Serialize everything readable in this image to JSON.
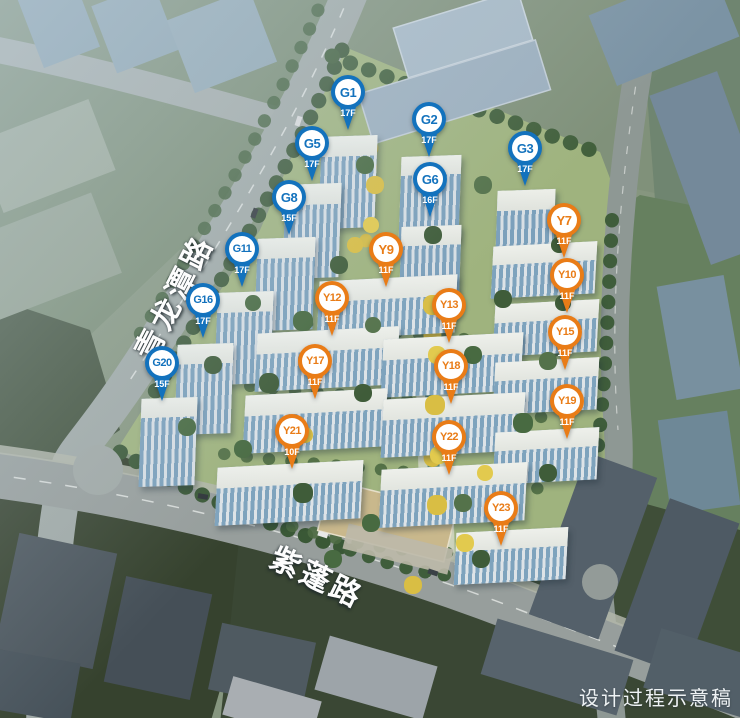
{
  "scene": {
    "watermark": "设计过程示意稿",
    "roads": [
      {
        "name": "青龙潭路"
      },
      {
        "name": "紫蓬路"
      }
    ]
  },
  "colors": {
    "pin_blue": "#1372bd",
    "pin_orange": "#e97c17"
  },
  "pins": [
    {
      "id": "G1",
      "floor": "17F",
      "type": "blue",
      "x": 348,
      "y": 92
    },
    {
      "id": "G2",
      "floor": "17F",
      "type": "blue",
      "x": 429,
      "y": 119
    },
    {
      "id": "G3",
      "floor": "17F",
      "type": "blue",
      "x": 525,
      "y": 148
    },
    {
      "id": "G5",
      "floor": "17F",
      "type": "blue",
      "x": 312,
      "y": 143
    },
    {
      "id": "G6",
      "floor": "16F",
      "type": "blue",
      "x": 430,
      "y": 179
    },
    {
      "id": "G8",
      "floor": "15F",
      "type": "blue",
      "x": 289,
      "y": 197
    },
    {
      "id": "G11",
      "floor": "17F",
      "type": "blue",
      "x": 242,
      "y": 249
    },
    {
      "id": "G16",
      "floor": "17F",
      "type": "blue",
      "x": 203,
      "y": 300
    },
    {
      "id": "G20",
      "floor": "15F",
      "type": "blue",
      "x": 162,
      "y": 363
    },
    {
      "id": "Y7",
      "floor": "11F",
      "type": "orange",
      "x": 564,
      "y": 220
    },
    {
      "id": "Y9",
      "floor": "11F",
      "type": "orange",
      "x": 386,
      "y": 249
    },
    {
      "id": "Y10",
      "floor": "11F",
      "type": "orange",
      "x": 567,
      "y": 275
    },
    {
      "id": "Y12",
      "floor": "11F",
      "type": "orange",
      "x": 332,
      "y": 298
    },
    {
      "id": "Y13",
      "floor": "11F",
      "type": "orange",
      "x": 449,
      "y": 305
    },
    {
      "id": "Y15",
      "floor": "11F",
      "type": "orange",
      "x": 565,
      "y": 332
    },
    {
      "id": "Y17",
      "floor": "11F",
      "type": "orange",
      "x": 315,
      "y": 361
    },
    {
      "id": "Y18",
      "floor": "11F",
      "type": "orange",
      "x": 451,
      "y": 366
    },
    {
      "id": "Y19",
      "floor": "11F",
      "type": "orange",
      "x": 567,
      "y": 401
    },
    {
      "id": "Y21",
      "floor": "10F",
      "type": "orange",
      "x": 292,
      "y": 431
    },
    {
      "id": "Y22",
      "floor": "11F",
      "type": "orange",
      "x": 449,
      "y": 437
    },
    {
      "id": "Y23",
      "floor": "11F",
      "type": "orange",
      "x": 501,
      "y": 508
    }
  ]
}
